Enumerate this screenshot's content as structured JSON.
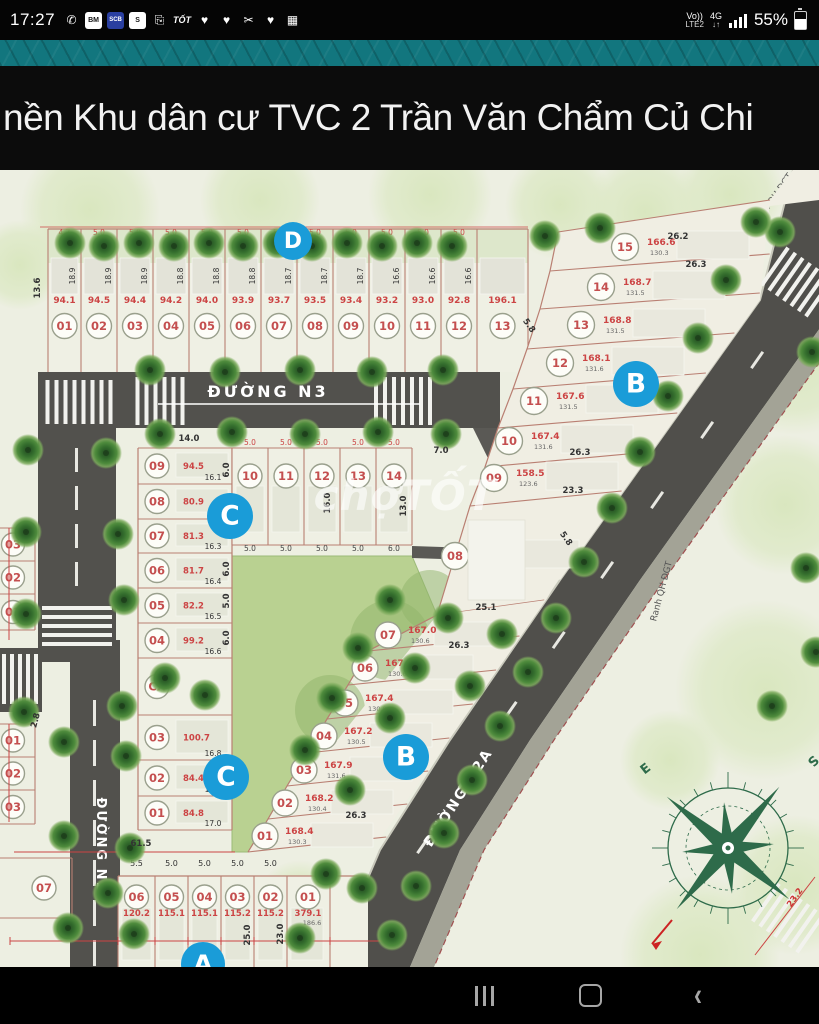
{
  "status_bar": {
    "time": "17:27",
    "left_icons": [
      {
        "name": "viber-icon",
        "glyph": "✆",
        "style": "plain"
      },
      {
        "name": "baomoi-icon",
        "glyph": "BM",
        "style": "box"
      },
      {
        "name": "scb-icon",
        "glyph": "SCB",
        "style": "scb"
      },
      {
        "name": "messenger-icon",
        "glyph": "S",
        "style": "box"
      },
      {
        "name": "share-icon",
        "glyph": "⎘",
        "style": "plain"
      },
      {
        "name": "tot-icon",
        "glyph": "TỐT",
        "style": "txt"
      },
      {
        "name": "lazada-icon",
        "glyph": "♥",
        "style": "plain"
      },
      {
        "name": "lazada-icon",
        "glyph": "♥",
        "style": "plain"
      },
      {
        "name": "screenshot-icon",
        "glyph": "✂",
        "style": "plain"
      },
      {
        "name": "lazada-icon",
        "glyph": "♥",
        "style": "plain"
      },
      {
        "name": "gallery-icon",
        "glyph": "▦",
        "style": "plain"
      }
    ],
    "volte": "Vo))",
    "lte": "LTE2",
    "net": "4G",
    "arrows": "↓↑",
    "battery": "55%"
  },
  "title_bar": {
    "title": "nền Khu dân cư TVC 2 Trần Văn Chẩm Củ Chi"
  },
  "map": {
    "watermark": "chợTỐT",
    "roads": {
      "n3": "ĐƯỜNG N3",
      "n1": "ĐƯỜNG N1",
      "n2a": "ĐƯỜNG N2A",
      "boundary1": "Ranh QH ĐGT",
      "boundary2": "Ranh QH ĐGT"
    },
    "section_badges": [
      {
        "label": "D",
        "x": 293,
        "y": 241,
        "r": 19
      },
      {
        "label": "B",
        "x": 636,
        "y": 384,
        "r": 23
      },
      {
        "label": "C",
        "x": 230,
        "y": 516,
        "r": 23
      },
      {
        "label": "B",
        "x": 406,
        "y": 757,
        "r": 23
      },
      {
        "label": "C",
        "x": 226,
        "y": 777,
        "r": 23
      },
      {
        "label": "A",
        "x": 203,
        "y": 964,
        "r": 22
      }
    ],
    "d_row": [
      {
        "no": "01",
        "area": "94.1",
        "w": "4.7",
        "d": "18.9"
      },
      {
        "no": "02",
        "area": "94.5",
        "w": "5.0",
        "d": "18.9"
      },
      {
        "no": "03",
        "area": "94.4",
        "w": "5.0",
        "d": "18.9"
      },
      {
        "no": "04",
        "area": "94.2",
        "w": "5.0",
        "d": "18.8"
      },
      {
        "no": "05",
        "area": "94.0",
        "w": "5.0",
        "d": "18.8"
      },
      {
        "no": "06",
        "area": "93.9",
        "w": "5.0",
        "d": "18.8"
      },
      {
        "no": "07",
        "area": "93.7",
        "w": "5.0",
        "d": "18.7"
      },
      {
        "no": "08",
        "area": "93.5",
        "w": "5.0",
        "d": "18.7"
      },
      {
        "no": "09",
        "area": "93.4",
        "w": "5.0",
        "d": "18.7"
      },
      {
        "no": "10",
        "area": "93.2",
        "w": "5.0",
        "d": "16.6"
      },
      {
        "no": "11",
        "area": "93.0",
        "w": "5.0",
        "d": "16.6"
      },
      {
        "no": "12",
        "area": "92.8",
        "w": "5.0",
        "d": "16.6"
      },
      {
        "no": "13",
        "area": "196.1",
        "w": "",
        "d": ""
      }
    ],
    "b_upper": [
      {
        "no": "15",
        "area": "166.6",
        "sub": "130.3",
        "cx": 625,
        "cy": 247
      },
      {
        "no": "14",
        "area": "168.7",
        "sub": "131.5",
        "cx": 601,
        "cy": 287
      },
      {
        "no": "13",
        "area": "168.8",
        "sub": "131.5",
        "cx": 581,
        "cy": 325
      },
      {
        "no": "12",
        "area": "168.1",
        "sub": "131.6",
        "cx": 560,
        "cy": 363
      },
      {
        "no": "11",
        "area": "167.6",
        "sub": "131.5",
        "cx": 534,
        "cy": 401
      },
      {
        "no": "10",
        "area": "167.4",
        "sub": "131.6",
        "cx": 509,
        "cy": 441
      },
      {
        "no": "09",
        "area": "158.5",
        "sub": "123.6",
        "cx": 494,
        "cy": 478
      },
      {
        "no": "08",
        "area": "675.4",
        "sub": "548.2",
        "cx": 455,
        "cy": 556
      }
    ],
    "b_lower": [
      {
        "no": "07",
        "area": "167.0",
        "sub": "130.6",
        "cx": 388,
        "cy": 635
      },
      {
        "no": "06",
        "area": "167.5",
        "sub": "130.6",
        "cx": 365,
        "cy": 668
      },
      {
        "no": "05",
        "area": "167.4",
        "sub": "130.9",
        "cx": 345,
        "cy": 703
      },
      {
        "no": "04",
        "area": "167.2",
        "sub": "130.5",
        "cx": 324,
        "cy": 736
      },
      {
        "no": "03",
        "area": "167.9",
        "sub": "131.6",
        "cx": 304,
        "cy": 770
      },
      {
        "no": "02",
        "area": "168.2",
        "sub": "130.4",
        "cx": 285,
        "cy": 803
      },
      {
        "no": "01",
        "area": "168.4",
        "sub": "130.3",
        "cx": 265,
        "cy": 836
      }
    ],
    "c_col": [
      {
        "no": "09",
        "area": "94.5",
        "d": "16.1"
      },
      {
        "no": "08",
        "area": "80.9",
        "d": ""
      },
      {
        "no": "07",
        "area": "81.3",
        "d": "16.3"
      },
      {
        "no": "06",
        "area": "81.7",
        "d": "16.4"
      },
      {
        "no": "05",
        "area": "82.2",
        "d": "16.5"
      },
      {
        "no": "04",
        "area": "99.2",
        "d": "16.6"
      },
      {
        "no": "CX",
        "area": "",
        "d": ""
      },
      {
        "no": "03",
        "area": "100.7",
        "d": "16.8"
      },
      {
        "no": "02",
        "area": "84.4",
        "d": "16.9"
      },
      {
        "no": "01",
        "area": "84.8",
        "d": "17.0"
      }
    ],
    "c_row": [
      {
        "no": "10",
        "wt": "5.0",
        "wb": "5.0"
      },
      {
        "no": "11",
        "wt": "5.0",
        "wb": "5.0"
      },
      {
        "no": "12",
        "wt": "5.0",
        "wb": "5.0"
      },
      {
        "no": "13",
        "wt": "5.0",
        "wb": "5.0"
      },
      {
        "no": "14",
        "wt": "5.0",
        "wb": "6.0"
      }
    ],
    "a_row": [
      {
        "no": "06",
        "area": "120.2",
        "w": "5.5"
      },
      {
        "no": "05",
        "area": "115.1",
        "w": "5.0"
      },
      {
        "no": "04",
        "area": "115.1",
        "w": "5.0"
      },
      {
        "no": "03",
        "area": "115.2",
        "w": "5.0"
      },
      {
        "no": "02",
        "area": "115.2",
        "w": "5.0"
      },
      {
        "no": "01",
        "area": "379.1",
        "sub": "186.6",
        "w": ""
      }
    ],
    "left_edge": {
      "group1": [
        "03",
        "02",
        "01"
      ],
      "group2": [
        "01",
        "02",
        "03"
      ],
      "corner": "07"
    },
    "dims": [
      {
        "t": "26.2",
        "x": 678,
        "y": 239
      },
      {
        "t": "26.3",
        "x": 696,
        "y": 267
      },
      {
        "t": "26.3",
        "x": 580,
        "y": 455
      },
      {
        "t": "23.3",
        "x": 573,
        "y": 493
      },
      {
        "t": "25.1",
        "x": 486,
        "y": 610
      },
      {
        "t": "26.3",
        "x": 459,
        "y": 648
      },
      {
        "t": "26.3",
        "x": 356,
        "y": 818
      },
      {
        "t": "61.5",
        "x": 141,
        "y": 846
      },
      {
        "t": "13.6",
        "x": 40,
        "y": 288,
        "rot": -90
      },
      {
        "t": "7.0",
        "x": 441,
        "y": 453
      },
      {
        "t": "14.0",
        "x": 189,
        "y": 441
      },
      {
        "t": "16.0",
        "x": 330,
        "y": 503,
        "rot": -90
      },
      {
        "t": "13.0",
        "x": 406,
        "y": 506,
        "rot": -90
      },
      {
        "t": "25.0",
        "x": 250,
        "y": 935,
        "rot": -90
      },
      {
        "t": "23.0",
        "x": 283,
        "y": 934,
        "rot": -90
      },
      {
        "t": "2.8",
        "x": 38,
        "y": 721,
        "rot": -75
      },
      {
        "t": "5.8",
        "x": 527,
        "y": 327,
        "rot": 55
      },
      {
        "t": "5.8",
        "x": 564,
        "y": 540,
        "rot": 55
      },
      {
        "t": "23.2",
        "x": 797,
        "y": 899,
        "rot": -55,
        "c": "#cc3333"
      },
      {
        "t": "6.0",
        "x": 229,
        "y": 470,
        "rot": -90
      },
      {
        "t": "6.0",
        "x": 229,
        "y": 569,
        "rot": -90
      },
      {
        "t": "5.0",
        "x": 229,
        "y": 601,
        "rot": -90
      },
      {
        "t": "6.0",
        "x": 229,
        "y": 638,
        "rot": -90
      }
    ],
    "compass": {
      "e": "E",
      "s": "S"
    }
  },
  "nav_bar": {
    "recents": "recents",
    "home": "home",
    "back": "back"
  }
}
